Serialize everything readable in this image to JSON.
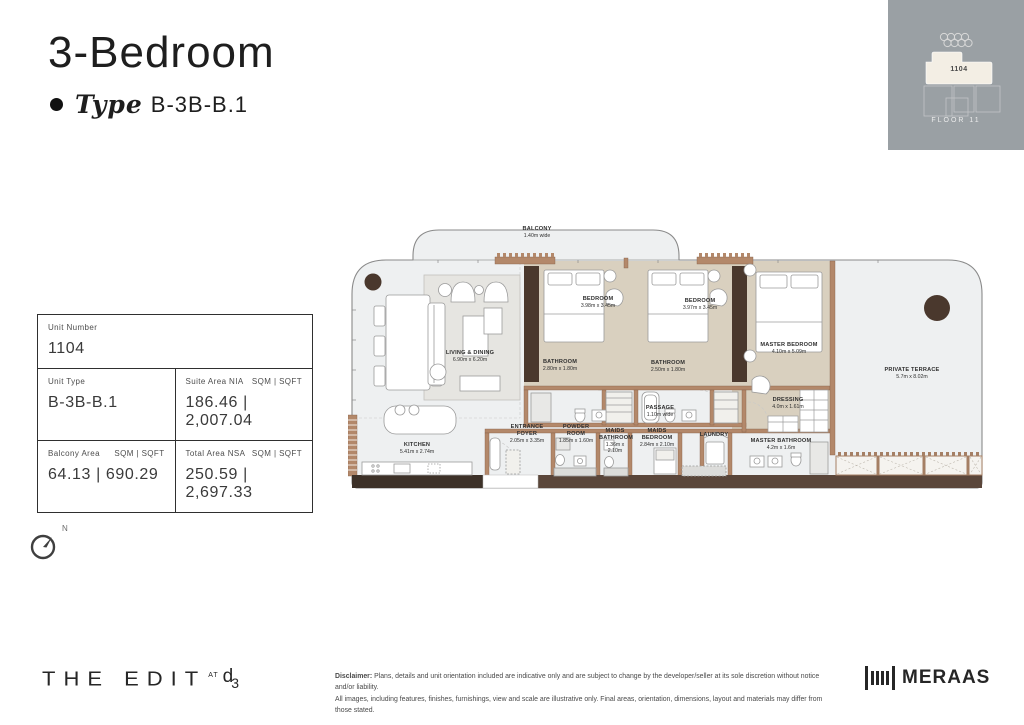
{
  "header": {
    "title": "3-Bedroom",
    "type_label": "Type",
    "type_value": "B-3B-B.1"
  },
  "keyplan": {
    "unit": "1104",
    "floor_label": "FLOOR  11"
  },
  "info_table": {
    "unit_number_label": "Unit Number",
    "unit_number": "1104",
    "unit_type_label": "Unit Type",
    "unit_type": "B-3B-B.1",
    "suite_label": "Suite Area NIA",
    "suite_units": "SQM  |  SQFT",
    "suite_value": "186.46  |  2,007.04",
    "balcony_label": "Balcony Area",
    "balcony_units": "SQM  |  SQFT",
    "balcony_value": "64.13  |  690.29",
    "total_label": "Total Area NSA",
    "total_units": "SQM  |  SQFT",
    "total_value": "250.59  |  2,697.33"
  },
  "compass": {
    "north_label": "N"
  },
  "plan": {
    "rooms": [
      {
        "name": "BALCONY",
        "dims": "1.40m wide"
      },
      {
        "name": "LIVING & DINING",
        "dims": "6.90m x 6.20m"
      },
      {
        "name": "BEDROOM",
        "dims": "3.98m x 3.45m"
      },
      {
        "name": "BEDROOM",
        "dims": "3.97m x 3.45m"
      },
      {
        "name": "MASTER BEDROOM",
        "dims": "4.10m x 5.09m"
      },
      {
        "name": "BATHROOM",
        "dims": "2.80m x 1.80m"
      },
      {
        "name": "BATHROOM",
        "dims": "2.50m x 1.80m"
      },
      {
        "name": "PRIVATE TERRACE",
        "dims": "5.7m x 8.02m"
      },
      {
        "name": "DRESSING",
        "dims": "4.0m x 1.61m"
      },
      {
        "name": "PASSAGE",
        "dims": "1.10m wide"
      },
      {
        "name": "KITCHEN",
        "dims": "5.41m x 2.74m"
      },
      {
        "name": "ENTRANCE FOYER",
        "dims": "2.05m x 3.35m"
      },
      {
        "name": "POWDER ROOM",
        "dims": "1.85m x 1.60m"
      },
      {
        "name": "MAIDS BATHROOM",
        "dims": "1.36m x 2.10m"
      },
      {
        "name": "MAIDS BEDROOM",
        "dims": "2.84m x 2.10m"
      },
      {
        "name": "LAUNDRY",
        "dims": ""
      },
      {
        "name": "MASTER BATHROOM",
        "dims": "4.2m x 1.6m"
      }
    ]
  },
  "footer": {
    "brand": "THE EDIT",
    "brand_at": "AT",
    "brand_d": "d",
    "brand_3": "3",
    "disclaimer_label": "Disclaimer:",
    "disclaimer_line1": " Plans, details and unit orientation included are indicative only and are subject to change by the developer/seller at its sole discretion without notice and/or liability.",
    "disclaimer_line2": "All images, including features, finishes, furnishings, view and scale are illustrative only. Final areas, orientation, dimensions, layout and materials may differ from those stated.",
    "meraas": "MERAAS"
  },
  "colors": {
    "keyplan_bg": "#9aa0a4",
    "highlight_unit": "#f3eee4",
    "floor_gray": "#eef0f1",
    "floor_tan": "#d9d0bf",
    "wall_brown": "#b3886a",
    "dark_brown": "#4a382d",
    "bottom_band": "#5a463a"
  }
}
